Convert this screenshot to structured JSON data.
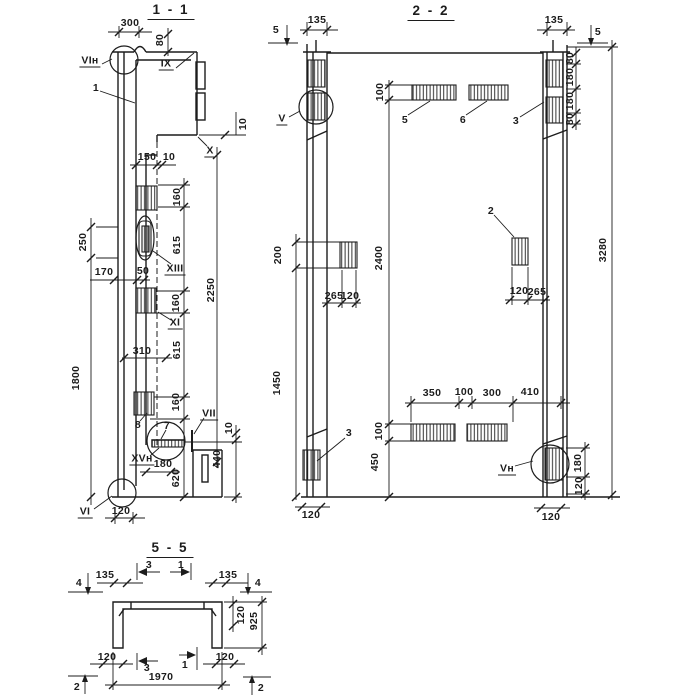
{
  "meta": {
    "bg": "#ffffff",
    "ink": "#1c1c1c",
    "kind": "structural panel shop drawing, sections"
  },
  "s11": {
    "title": "1 - 1",
    "d300": "300",
    "d80": "80",
    "node_vi_n": "VIн",
    "node_ix": "IX",
    "part1": "1",
    "d10_step": "10",
    "node_x": "X",
    "d150": "150",
    "d10_face": "10",
    "d160_1": "160",
    "d250": "250",
    "d615_1": "615",
    "node_xiii": "XIII",
    "d170": "170",
    "d50": "50",
    "d2250": "2250",
    "d160_2": "160",
    "node_xi": "XI",
    "d310": "310",
    "d615_2": "615",
    "d1800": "1800",
    "d160_3": "160",
    "part8": "8",
    "part7": "7",
    "node_vii": "VII",
    "d10_r": "10",
    "node_xv_n": "XVн",
    "d180": "180",
    "d620": "620",
    "d440": "440",
    "node_vi": "VI",
    "d120": "120"
  },
  "s22": {
    "title": "2 - 2",
    "cut5_left": "5",
    "cut5_right": "5",
    "d135_l": "135",
    "d135_r": "135",
    "d80_t": "80",
    "d180_t": "180",
    "d180_t2": "180",
    "d80_t2": "80",
    "d100_top": "100",
    "part5": "5",
    "part6": "6",
    "part3_top": "3",
    "node_v": "V",
    "part2": "2",
    "d200": "200",
    "d2400": "2400",
    "d3280": "3280",
    "d265_l": "265",
    "d120_l": "120",
    "d120_r": "120",
    "d265_r": "265",
    "d1450": "1450",
    "d350": "350",
    "d100_mid": "100",
    "d300": "300",
    "d410": "410",
    "d100_bot": "100",
    "part3_bot": "3",
    "d450": "450",
    "node_v_n": "Vн",
    "d180_b": "180",
    "d120_b": "120",
    "d120_bl": "120",
    "d120_br": "120"
  },
  "s55": {
    "title": "5 - 5",
    "cut4_l": "4",
    "cut4_r": "4",
    "cut3_t": "3",
    "cut1_t": "1",
    "cut3_b": "3",
    "cut1_b": "1",
    "cut2_l": "2",
    "cut2_r": "2",
    "d135_l": "135",
    "d135_r": "135",
    "d120_top": "120",
    "d925": "925",
    "d120_bl": "120",
    "d120_br": "120",
    "d1970": "1970"
  }
}
